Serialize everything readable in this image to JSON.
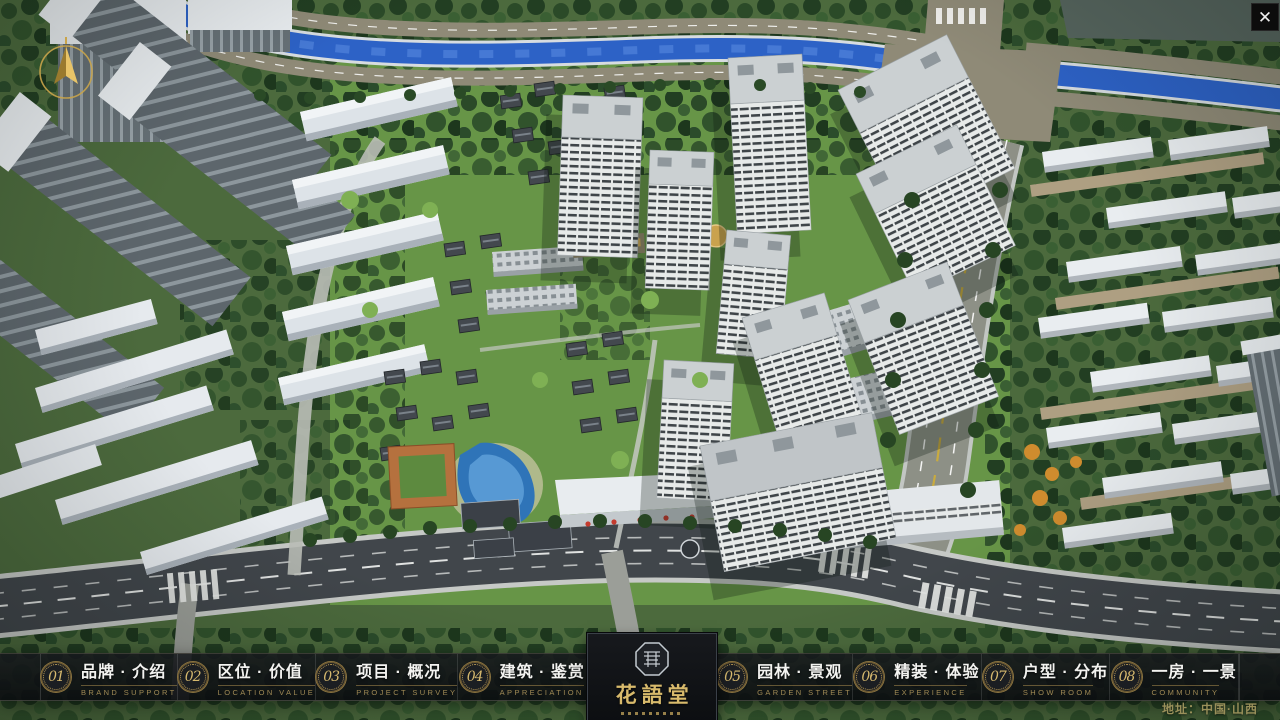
{
  "window": {
    "close_label": "✕"
  },
  "nav": {
    "items": [
      {
        "num": "01",
        "label": "品牌 · 介绍",
        "sub": "BRAND SUPPORT"
      },
      {
        "num": "02",
        "label": "区位 · 价值",
        "sub": "LOCATION VALUE"
      },
      {
        "num": "03",
        "label": "项目 · 概况",
        "sub": "PROJECT SURVEY"
      },
      {
        "num": "04",
        "label": "建筑 · 鉴赏",
        "sub": "APPRECIATION"
      },
      {
        "num": "05",
        "label": "园林 · 景观",
        "sub": "GARDEN STREET"
      },
      {
        "num": "06",
        "label": "精装 · 体验",
        "sub": "EXPERIENCE"
      },
      {
        "num": "07",
        "label": "户型 · 分布",
        "sub": "SHOW ROOM"
      },
      {
        "num": "08",
        "label": "一房 · 一景",
        "sub": "COMMUNITY"
      }
    ]
  },
  "logo": {
    "title": "花語堂"
  },
  "footer": {
    "address": "地址：中国·山西"
  },
  "palette": {
    "gold": "#c9a45a",
    "nav_bg": "rgba(15,17,20,0.88)",
    "river_blue": "#2d62c6",
    "road_dark": "#41464b",
    "road_tan": "#8f8a77",
    "tree_dark": "#24411f",
    "lawn_green": "#679547",
    "building_white": "#e8ecef"
  }
}
